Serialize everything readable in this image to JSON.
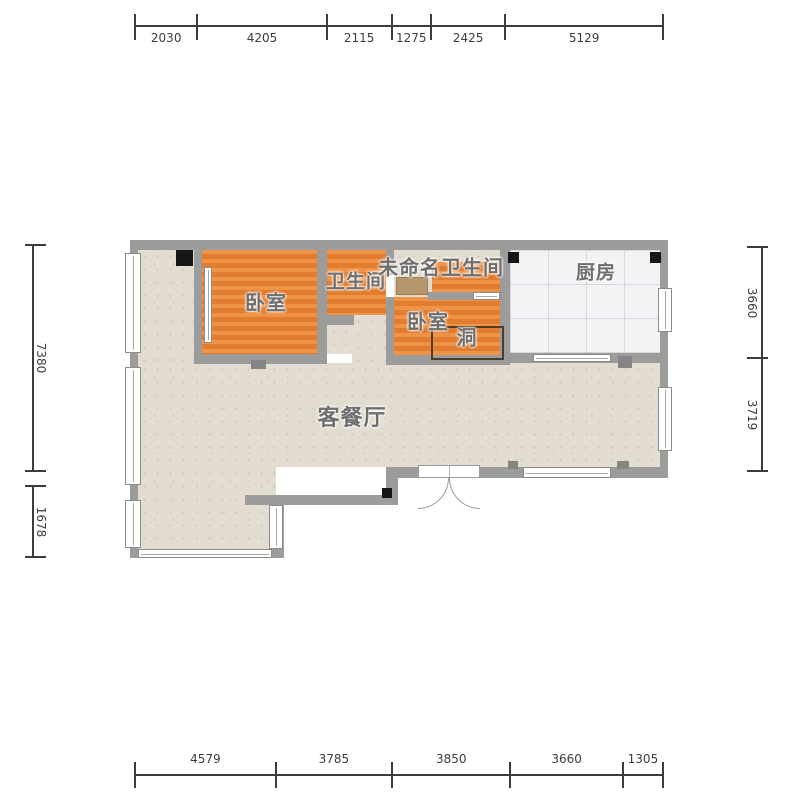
{
  "rooms": {
    "bedroom1": "卧室",
    "bathroom1": "卫生间",
    "unnamed_bathroom": "未命名卫生间",
    "bedroom2": "卧室",
    "hole": "洞",
    "kitchen": "厨房",
    "living_dining": "客餐厅"
  },
  "dimensions": {
    "top": [
      "2030",
      "4205",
      "2115",
      "1275",
      "2425",
      "5129"
    ],
    "bottom": [
      "4579",
      "3785",
      "3850",
      "3660",
      "1305"
    ],
    "left": [
      "7380",
      "1678"
    ],
    "right": [
      "3660",
      "3719"
    ]
  },
  "colors": {
    "wall": "#9c9c9c",
    "pillar": "#161616",
    "wood_floor": "#e5823a",
    "living_floor": "#e2ddd0",
    "tile_floor": "#f3f3f5",
    "vanity": "#b6976c",
    "hole_outline": "#4f3b26",
    "room_label": "#6e6e6e",
    "dimension_text": "#3c3c3c"
  }
}
